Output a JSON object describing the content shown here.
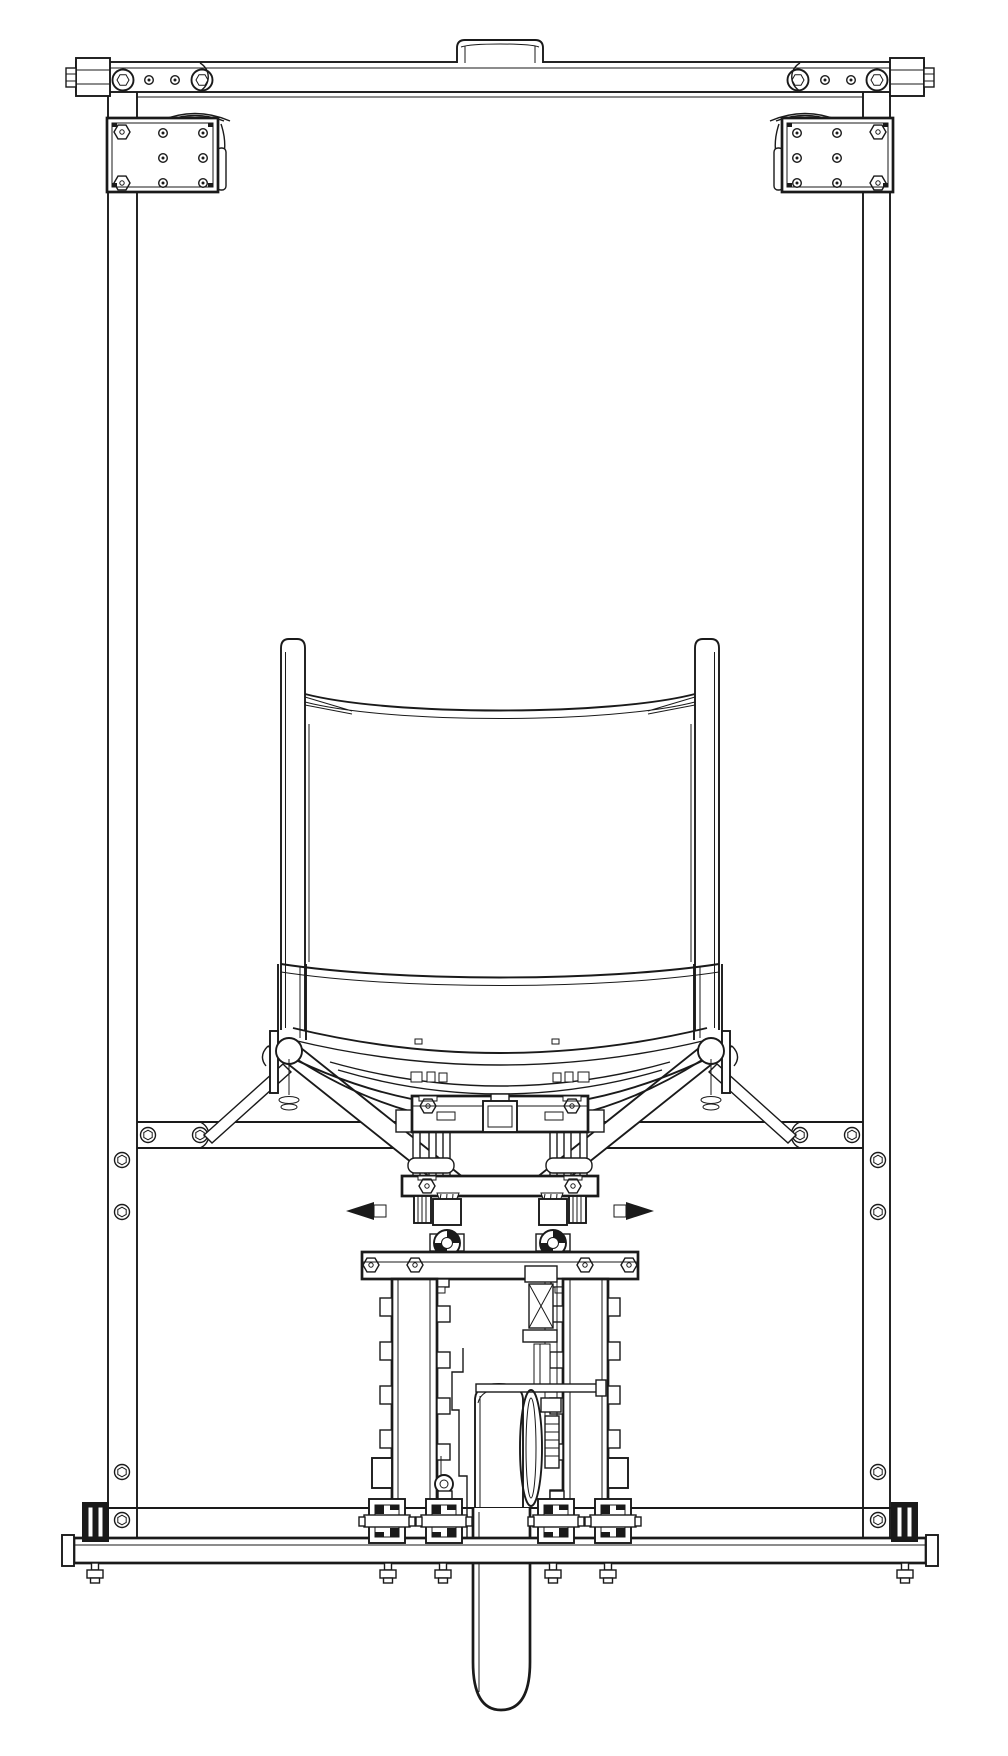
{
  "meta": {
    "title": "Black-and-white CAD wireframe drawing, front elevation: sling chair mounted in a rectangular test frame above a central motor gearbox column",
    "drawing_type": "technical line drawing",
    "text_annotations": "none",
    "colors": {
      "line": "#1a1a1a",
      "background": "#ffffff"
    }
  },
  "components": {
    "frame": [
      "top-crossbar",
      "top-bar-end-caps",
      "top-center-tab",
      "left-corner-plate",
      "right-corner-plate",
      "corner-rollers",
      "left-upright-post",
      "right-upright-post",
      "mid-rail",
      "lower-rail",
      "base-bar",
      "base-end-clamps",
      "foot-bolts"
    ],
    "chair": [
      "left-back-post",
      "right-back-post",
      "sling-back-top-hem",
      "back-panel",
      "seat-back-bottom-rail",
      "seat-front-tube",
      "seat-sling-hem",
      "hem-buckle-tabs",
      "left-pivot",
      "right-pivot",
      "swing-arms",
      "pivot-links",
      "cradle-tubes"
    ],
    "mechanism": [
      "upper-clamp-plate",
      "u-bolts",
      "lower-clamp-plate",
      "side-spikes",
      "bearing-blocks",
      "gearbox-flange",
      "gearbox-side-walls",
      "motor-cylinder",
      "drive-shaft",
      "flywheel-disc",
      "gear-rack",
      "grommet",
      "pillow-blocks",
      "output-tube"
    ]
  },
  "fastener_counts": {
    "hex_socket_screws_on_rails_and_posts": 12,
    "top_bar_bolt_heads": 4,
    "corner_plate_holes_each": 6,
    "corner_plate_hex_bolts_each": 2,
    "hanging_foot_bolts": 6
  }
}
